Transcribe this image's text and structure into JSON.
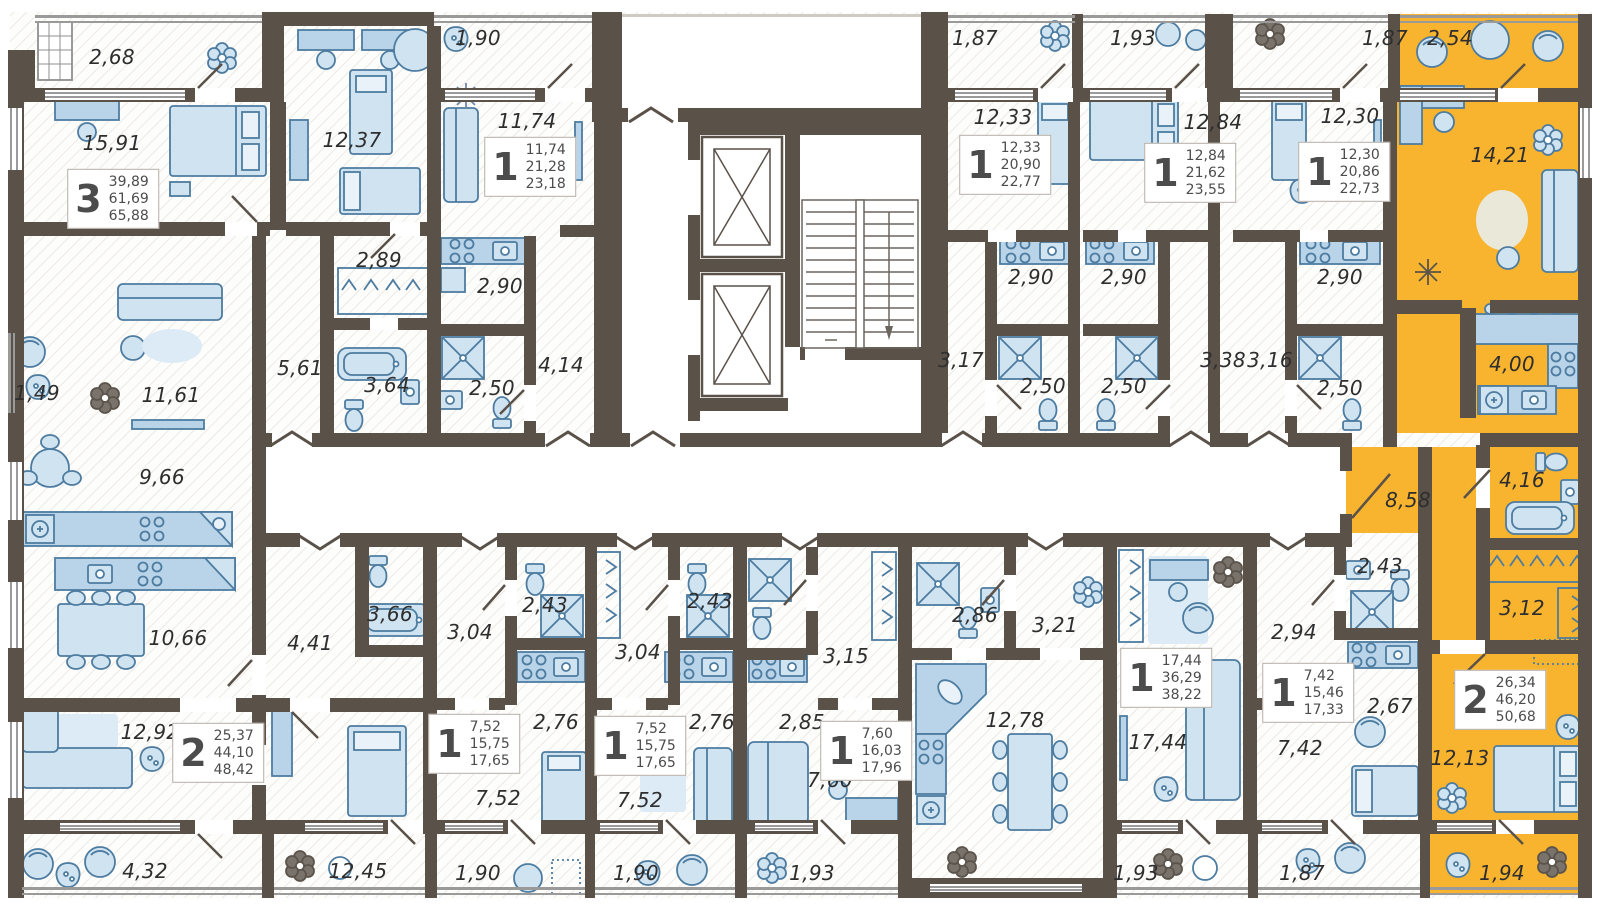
{
  "plan": {
    "type": "residential-floor-plan",
    "highlight_color": "#f8b42f",
    "wall_color": "#5a5149",
    "furniture_color": "#cfe3f1"
  },
  "rooms": [
    {
      "v": "2,68",
      "x": 112,
      "y": 57
    },
    {
      "v": "15,91",
      "x": 112,
      "y": 143
    },
    {
      "v": "12,37",
      "x": 352,
      "y": 140
    },
    {
      "v": "1,90",
      "x": 478,
      "y": 38
    },
    {
      "v": "11,74",
      "x": 527,
      "y": 121
    },
    {
      "v": "2,89",
      "x": 379,
      "y": 260
    },
    {
      "v": "2,90",
      "x": 500,
      "y": 286
    },
    {
      "v": "3,64",
      "x": 387,
      "y": 385
    },
    {
      "v": "2,50",
      "x": 492,
      "y": 388
    },
    {
      "v": "4,14",
      "x": 561,
      "y": 365
    },
    {
      "v": "1,49",
      "x": 37,
      "y": 393
    },
    {
      "v": "11,61",
      "x": 171,
      "y": 395
    },
    {
      "v": "5,61",
      "x": 300,
      "y": 368
    },
    {
      "v": "9,66",
      "x": 162,
      "y": 477
    },
    {
      "v": "1,87",
      "x": 975,
      "y": 38
    },
    {
      "v": "12,33",
      "x": 1003,
      "y": 117
    },
    {
      "v": "2,90",
      "x": 1031,
      "y": 277
    },
    {
      "v": "1,93",
      "x": 1133,
      "y": 38
    },
    {
      "v": "12,84",
      "x": 1213,
      "y": 122
    },
    {
      "v": "2,90",
      "x": 1124,
      "y": 277
    },
    {
      "v": "3,17",
      "x": 961,
      "y": 360
    },
    {
      "v": "2,50",
      "x": 1043,
      "y": 386
    },
    {
      "v": "2,50",
      "x": 1124,
      "y": 386
    },
    {
      "v": "3,38",
      "x": 1223,
      "y": 360
    },
    {
      "v": "1,87",
      "x": 1385,
      "y": 38
    },
    {
      "v": "12,30",
      "x": 1350,
      "y": 116
    },
    {
      "v": "2,90",
      "x": 1340,
      "y": 277
    },
    {
      "v": "3,16",
      "x": 1270,
      "y": 360
    },
    {
      "v": "2,50",
      "x": 1340,
      "y": 388
    },
    {
      "v": "2,54",
      "x": 1450,
      "y": 38
    },
    {
      "v": "14,21",
      "x": 1500,
      "y": 155
    },
    {
      "v": "4,00",
      "x": 1512,
      "y": 364
    },
    {
      "v": "8,58",
      "x": 1408,
      "y": 500
    },
    {
      "v": "4,16",
      "x": 1522,
      "y": 480
    },
    {
      "v": "3,12",
      "x": 1522,
      "y": 608
    },
    {
      "v": "12,13",
      "x": 1460,
      "y": 758
    },
    {
      "v": "1,94",
      "x": 1502,
      "y": 873
    },
    {
      "v": "10,66",
      "x": 178,
      "y": 638
    },
    {
      "v": "4,41",
      "x": 310,
      "y": 643
    },
    {
      "v": "3,66",
      "x": 390,
      "y": 614
    },
    {
      "v": "12,92",
      "x": 150,
      "y": 732
    },
    {
      "v": "4,32",
      "x": 145,
      "y": 871
    },
    {
      "v": "12,45",
      "x": 358,
      "y": 871
    },
    {
      "v": "3,04",
      "x": 470,
      "y": 632
    },
    {
      "v": "2,43",
      "x": 545,
      "y": 605
    },
    {
      "v": "2,76",
      "x": 556,
      "y": 722
    },
    {
      "v": "7,52",
      "x": 498,
      "y": 798
    },
    {
      "v": "1,90",
      "x": 478,
      "y": 873
    },
    {
      "v": "3,04",
      "x": 638,
      "y": 652
    },
    {
      "v": "2,43",
      "x": 710,
      "y": 601
    },
    {
      "v": "2,76",
      "x": 712,
      "y": 722
    },
    {
      "v": "7,52",
      "x": 640,
      "y": 800
    },
    {
      "v": "1,90",
      "x": 636,
      "y": 873
    },
    {
      "v": "2,85",
      "x": 802,
      "y": 722
    },
    {
      "v": "3,15",
      "x": 846,
      "y": 656
    },
    {
      "v": "7,60",
      "x": 830,
      "y": 780
    },
    {
      "v": "1,93",
      "x": 812,
      "y": 873
    },
    {
      "v": "2,86",
      "x": 975,
      "y": 615
    },
    {
      "v": "3,21",
      "x": 1055,
      "y": 625
    },
    {
      "v": "12,78",
      "x": 1015,
      "y": 720
    },
    {
      "v": "17,44",
      "x": 1158,
      "y": 742
    },
    {
      "v": "1,93",
      "x": 1136,
      "y": 873
    },
    {
      "v": "2,94",
      "x": 1294,
      "y": 632
    },
    {
      "v": "2,43",
      "x": 1380,
      "y": 566
    },
    {
      "v": "2,67",
      "x": 1390,
      "y": 706
    },
    {
      "v": "7,42",
      "x": 1300,
      "y": 748
    },
    {
      "v": "1,87",
      "x": 1302,
      "y": 873
    }
  ],
  "apartments": [
    {
      "n": "3",
      "a1": "39,89",
      "a2": "61,69",
      "a3": "65,88",
      "x": 113,
      "y": 199
    },
    {
      "n": "1",
      "a1": "11,74",
      "a2": "21,28",
      "a3": "23,18",
      "x": 530,
      "y": 167
    },
    {
      "n": "1",
      "a1": "12,33",
      "a2": "20,90",
      "a3": "22,77",
      "x": 1005,
      "y": 165
    },
    {
      "n": "1",
      "a1": "12,84",
      "a2": "21,62",
      "a3": "23,55",
      "x": 1190,
      "y": 173
    },
    {
      "n": "1",
      "a1": "12,30",
      "a2": "20,86",
      "a3": "22,73",
      "x": 1344,
      "y": 172
    },
    {
      "n": "2",
      "a1": "26,34",
      "a2": "46,20",
      "a3": "50,68",
      "x": 1500,
      "y": 700
    },
    {
      "n": "2",
      "a1": "25,37",
      "a2": "44,10",
      "a3": "48,42",
      "x": 218,
      "y": 753
    },
    {
      "n": "1",
      "a1": "7,52",
      "a2": "15,75",
      "a3": "17,65",
      "x": 474,
      "y": 744
    },
    {
      "n": "1",
      "a1": "7,52",
      "a2": "15,75",
      "a3": "17,65",
      "x": 640,
      "y": 746
    },
    {
      "n": "1",
      "a1": "7,60",
      "a2": "16,03",
      "a3": "17,96",
      "x": 866,
      "y": 751
    },
    {
      "n": "1",
      "a1": "17,44",
      "a2": "36,29",
      "a3": "38,22",
      "x": 1166,
      "y": 678
    },
    {
      "n": "1",
      "a1": "7,42",
      "a2": "15,46",
      "a3": "17,33",
      "x": 1308,
      "y": 693
    }
  ]
}
